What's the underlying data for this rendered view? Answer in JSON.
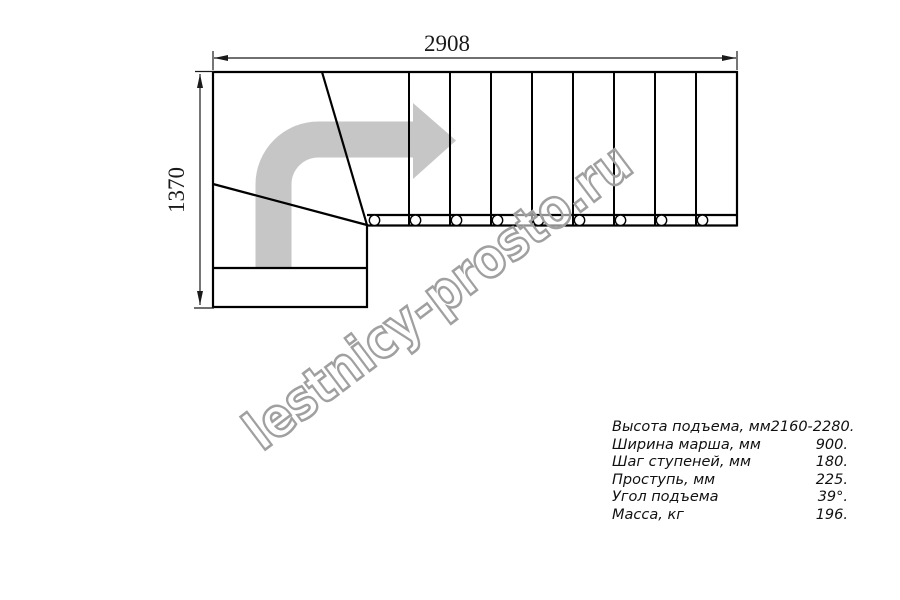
{
  "page": {
    "background": "#ffffff"
  },
  "drawing": {
    "top_dimension_label": "2908",
    "left_dimension_label": "1370",
    "watermark_text": "lestnicy-prosto.ru",
    "straight_flight_tread_count": 9,
    "baluster_count": 9,
    "winder_step_count": 3,
    "colors": {
      "line": "#000000",
      "arrow_fill": "#c6c6c6",
      "watermark_outline": "#a0a0a0",
      "watermark_fill": "rgba(255,255,255,0.55)"
    }
  },
  "specs": {
    "rows": [
      {
        "label": "Высота подъема, мм",
        "value": "2160-2280."
      },
      {
        "label": "Ширина марша, мм",
        "value": "900."
      },
      {
        "label": "Шаг ступеней, мм",
        "value": "180."
      },
      {
        "label": "Проступь, мм",
        "value": "225."
      },
      {
        "label": "Угол подъема",
        "value": "39°."
      },
      {
        "label": "Масса, кг",
        "value": "196."
      }
    ]
  }
}
